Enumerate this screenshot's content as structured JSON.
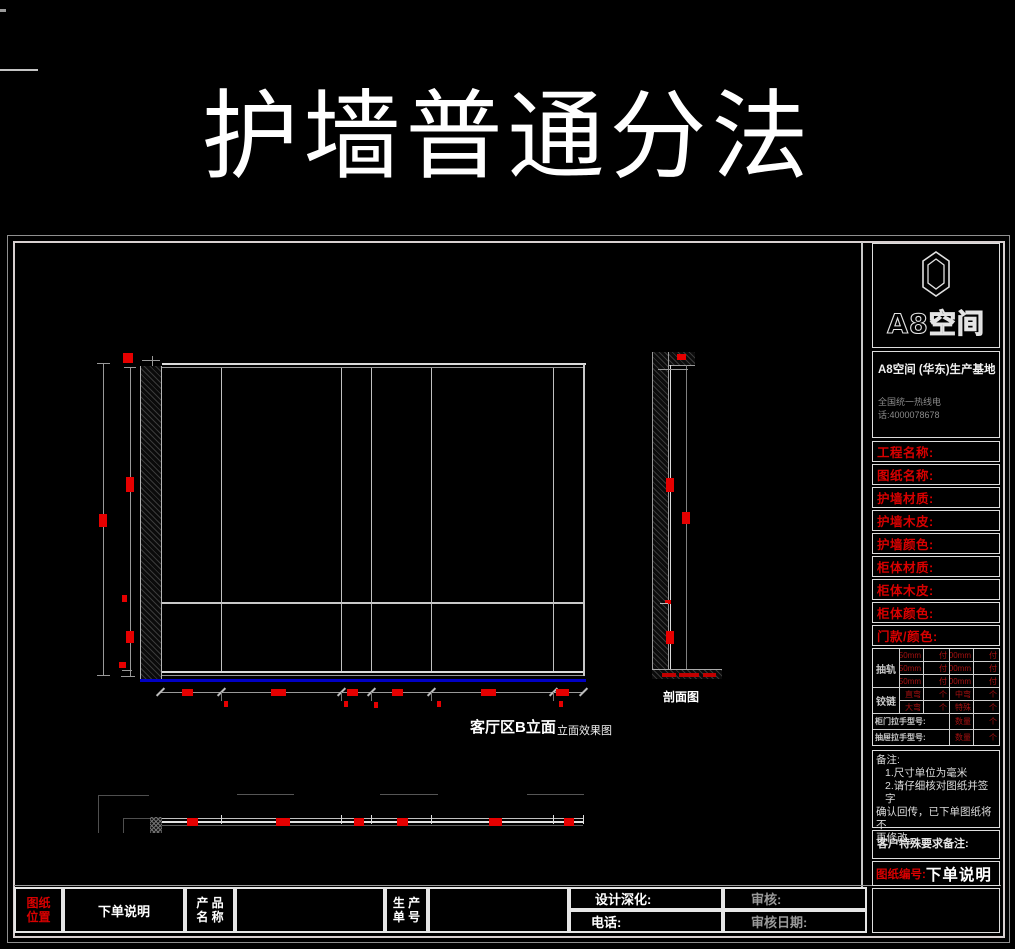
{
  "title": "护墙普通分法",
  "drawing": {
    "elevation_label": "客厅区B立面",
    "elevation_sublabel": "立面效果图",
    "section_label": "剖面图"
  },
  "sidebar": {
    "logo_text": "A8空间",
    "base_name": "A8空间 (华东)生产基地",
    "hotline": "全国统一热线电话:4000078678",
    "fields": [
      "工程名称:",
      "图纸名称:",
      "护墙材质:",
      "护墙木皮:",
      "护墙颜色:",
      "柜体材质:",
      "柜体木皮:",
      "柜体颜色:",
      "门款/颜色:"
    ],
    "hw": {
      "rail_label": "抽轨",
      "rails": [
        [
          "250mm",
          "付",
          "300mm",
          "付"
        ],
        [
          "350mm",
          "付",
          "400mm",
          "付"
        ],
        [
          "450mm",
          "付",
          "500mm",
          "付"
        ]
      ],
      "hinge_label": "铰链",
      "hinges": [
        [
          "直弯",
          "个",
          "中弯",
          "个"
        ],
        [
          "大弯",
          "个",
          "特殊",
          "个"
        ]
      ],
      "door_handle_label": "柜门拉手型号:",
      "drawer_handle_label": "抽屉拉手型号:",
      "qty_label": "数量",
      "unit_label": "个"
    },
    "notes": {
      "t": "备注:",
      "l1": "1.尺寸单位为毫米",
      "l2": "2.请仔细核对图纸并签字",
      "l3": "确认回传，已下单图纸将不",
      "l4": "再修改。"
    },
    "customer_note_label": "客户特殊要求备注:",
    "drawing_no_label": "图纸编号:",
    "drawing_no_value": "下单说明"
  },
  "footer": {
    "position_label_line1": "图纸",
    "position_label_line2": "位置",
    "position_value": "下单说明",
    "product_label_line1": "产 品",
    "product_label_line2": "名 称",
    "order_label_line1": "生 产",
    "order_label_line2": "单 号",
    "design_label": "设计深化:",
    "review_label": "审核:",
    "phone_label": "电话:",
    "review_date_label": "审核日期:"
  },
  "colors": {
    "accent_red": "#e60000",
    "table_red": "#a61010",
    "baseline_blue": "#0000c4",
    "line_gray": "#c8c8c8"
  }
}
